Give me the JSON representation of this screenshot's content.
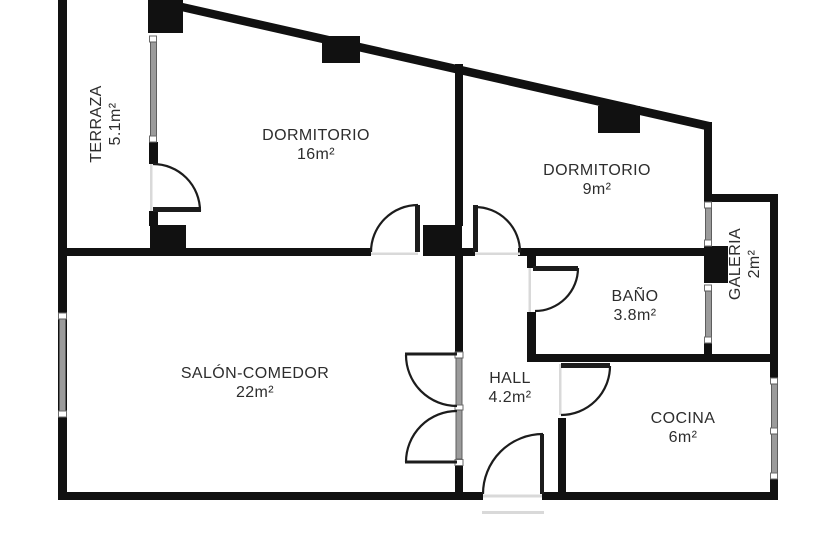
{
  "rooms": {
    "terraza": {
      "name": "TERRAZA",
      "area": "5.1m²"
    },
    "dormitorio_grande": {
      "name": "DORMITORIO",
      "area": "16m²"
    },
    "dormitorio_pequeno": {
      "name": "DORMITORIO",
      "area": "9m²"
    },
    "galeria": {
      "name": "GALERIA",
      "area": "2m²"
    },
    "bano": {
      "name": "BAÑO",
      "area": "3.8m²"
    },
    "salon_comedor": {
      "name": "SALÓN-COMEDOR",
      "area": "22m²"
    },
    "hall": {
      "name": "HALL",
      "area": "4.2m²"
    },
    "cocina": {
      "name": "COCINA",
      "area": "6m²"
    }
  },
  "colors": {
    "background": "#ffffff",
    "wall": "#111111",
    "door_line": "#1c1c1c",
    "window_glass": "#9b9b9b",
    "window_frame": "#5d5d5d",
    "label_text": "#2d2d2d"
  }
}
